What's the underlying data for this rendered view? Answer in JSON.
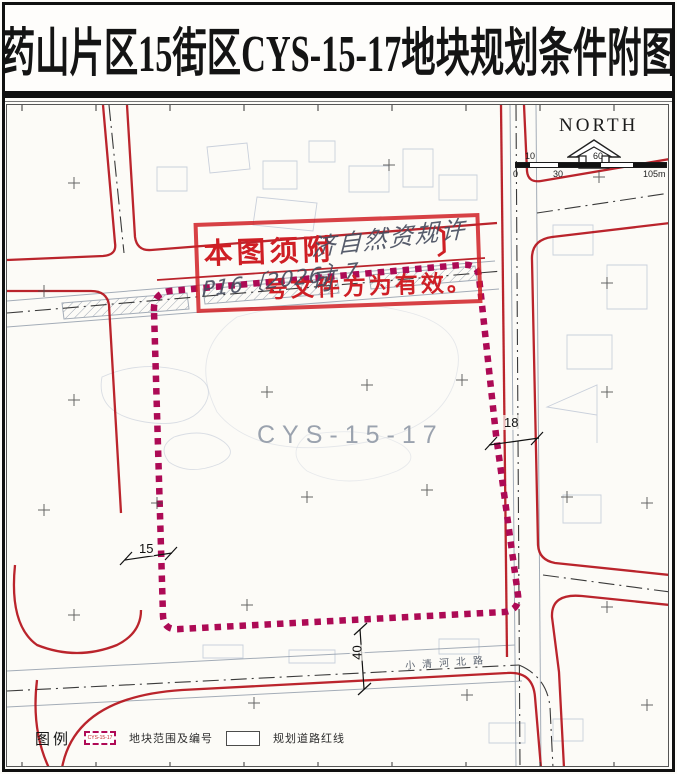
{
  "title": "药山片区15街区CYS-15-17地块规划条件附图",
  "compass": {
    "label": "NORTH"
  },
  "scale_bar": {
    "top_labels": [
      "10",
      "60"
    ],
    "bottom_labels": [
      "0",
      "30",
      "105m"
    ]
  },
  "stamp": {
    "printed_prefix": "本图须附",
    "printed_bracket": "〕",
    "printed_suffix": "号文件方为有效。",
    "handwritten_line1": "济自然资规许可",
    "handwritten_line2": "P16〔2026〕7"
  },
  "plot": {
    "label": "CYS-15-17"
  },
  "dimensions": {
    "right_road_width": "18",
    "left_road_width": "15",
    "bottom_road_width": "40"
  },
  "roads": {
    "bottom_road_name": "小清河北路"
  },
  "legend": {
    "title": "图例",
    "items": [
      {
        "symbol_text": "CYS-15-17",
        "label": "地块范围及编号"
      },
      {
        "label": "规划道路红线"
      }
    ]
  },
  "colors": {
    "road_red": "#b5121b",
    "boundary_magenta": "#ad0a55",
    "stamp_red": "#cf1f25",
    "handwriting_ink": "#464c5e"
  }
}
